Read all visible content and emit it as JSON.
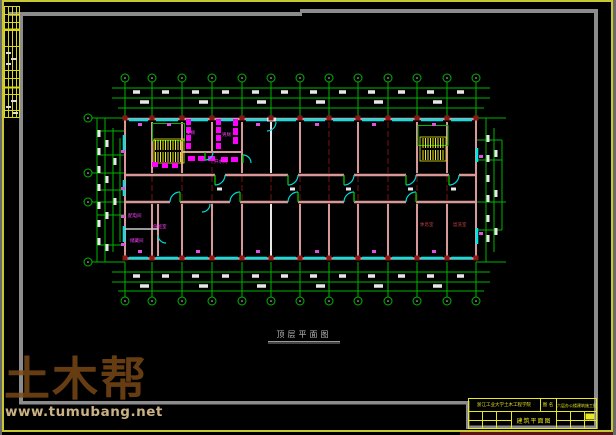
{
  "watermark": {
    "brand": "土木帮",
    "url": "www.tumubang.net"
  },
  "caption": "顶层平面图",
  "title_block": {
    "org": "浙江工业大学土木工程学院",
    "name_label": "图 名",
    "project": "六层办公楼建筑施工图设计",
    "drawing_title": "建筑平面图"
  },
  "room_labels": {
    "toilet_female": "女厕",
    "toilet_male": "男厕",
    "water_room": "开水间",
    "power_room": "配电间",
    "duty_room": "值班室",
    "storage_room": "储藏间",
    "lounge": "休息室",
    "washroom": "盥洗室"
  },
  "colors": {
    "grid_green": "#00b400",
    "window_cyan": "#00e5e5",
    "wall_pink": "#d89898",
    "axis_red": "#7a1212",
    "stair_yellow": "#e8e820",
    "fixture_magenta": "#ff00ff",
    "frame_gray": "#8c8c8c",
    "border_yellow": "#c8c832",
    "watermark_brown": "#7d4b16"
  }
}
